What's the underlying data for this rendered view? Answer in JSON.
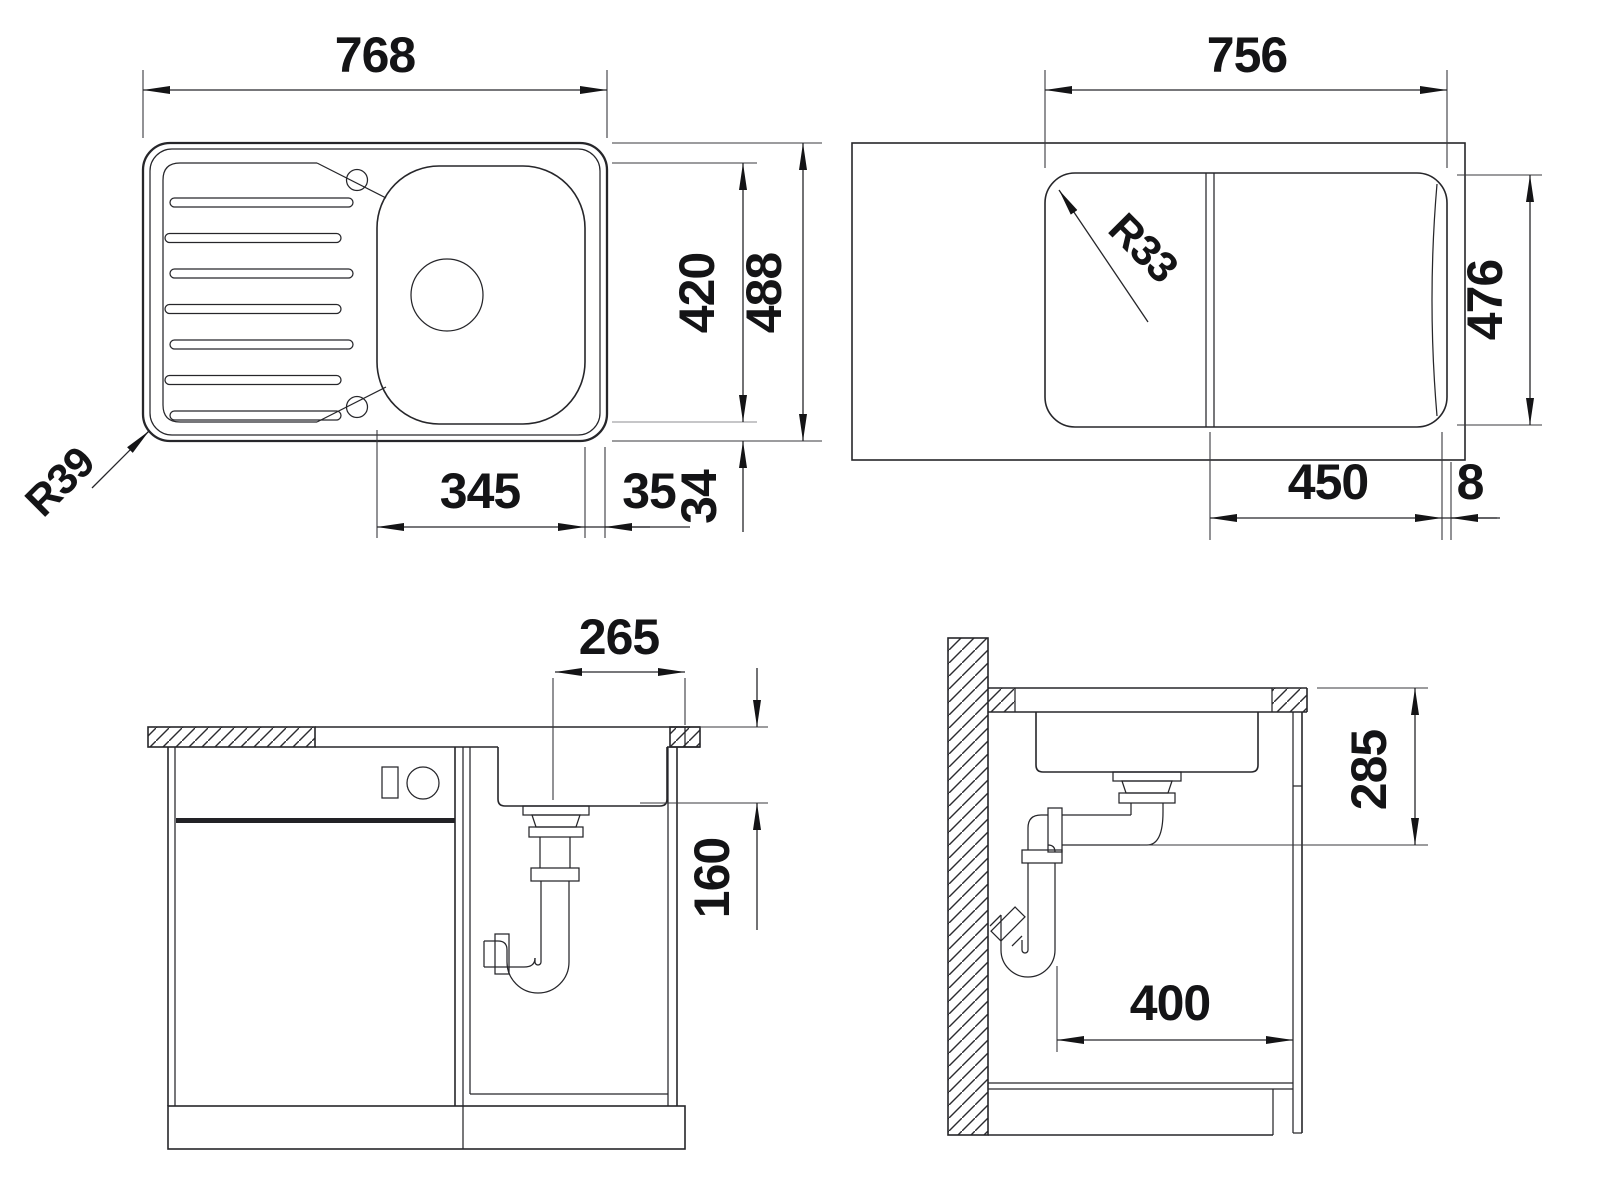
{
  "drawing": {
    "top_view": {
      "width": "768",
      "inner_depth": "420",
      "depth": "488",
      "bowl_width": "345",
      "bowl_right_gap": "35",
      "bowl_front_gap": "34",
      "radius": "R39"
    },
    "underside_view": {
      "width": "756",
      "depth": "476",
      "bowl_width": "450",
      "edge_gap": "8",
      "radius": "R33"
    },
    "front_section": {
      "drain_offset": "265",
      "outlet_height": "160"
    },
    "side_section": {
      "outlet_depth": "285",
      "clearance": "400"
    }
  }
}
